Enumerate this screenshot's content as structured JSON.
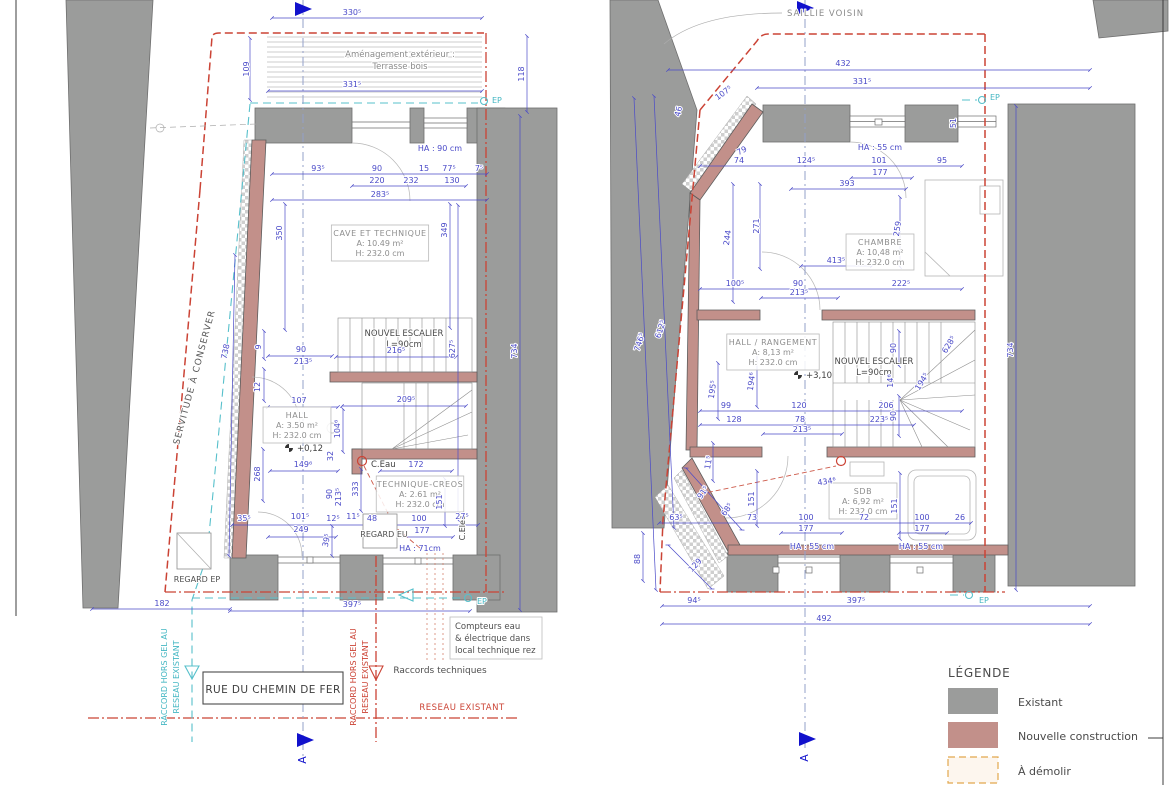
{
  "colors": {
    "existing": "#9b9c9b",
    "new_construction": "#c2908a",
    "demolish_fill": "#fdf6ee",
    "demolish_border": "#e2a84e",
    "dimension": "#4a4ac8",
    "boundary_red": "#cb4335",
    "utility_cyan": "#45b7c3",
    "section_blue": "#1111cc",
    "text_gray": "#8e8e8e",
    "text_dark": "#4a4a4a"
  },
  "legend": {
    "title": "LÉGENDE",
    "items": [
      {
        "label": "Existant"
      },
      {
        "label": "Nouvelle construction"
      },
      {
        "label": "À démolir"
      }
    ]
  },
  "street": {
    "label": "RUE DU CHEMIN DE FER"
  },
  "annotations": {
    "saillie_voisin": "SAILLIE VOISIN",
    "amenagement_line1": "Aménagement extérieur :",
    "amenagement_line2": "Terrasse bois",
    "servitude": "SERVITUDE À CONSERVER",
    "raccord_gel_line1": "RACCORD HORS GEL AU",
    "raccord_gel_line2": "RESEAU EXISTANT",
    "raccords_techniques": "Raccords techniques",
    "reseau_existant": "RESEAU EXISTANT",
    "compteurs_lines": [
      "Compteurs eau",
      "& électrique  dans",
      "local technique rez"
    ],
    "regard_ep": "REGARD EP",
    "regard_eu": "REGARD EU",
    "c_eau": "C.Eau",
    "c_elec": "C.Elec",
    "ep": "EP",
    "section_letter": "A",
    "ha_90": "HA : 90 cm",
    "ha_71": "HA : 71cm",
    "ha_55": "HA : 55 cm",
    "level_left": "+0,12",
    "level_right": "+3,10"
  },
  "rooms": [
    {
      "id": "cave",
      "cx": 380,
      "cy": 243,
      "lines": [
        "CAVE ET TECHNIQUE",
        "A: 10.49 m²",
        "H: 232.0 cm"
      ]
    },
    {
      "id": "hall-left",
      "cx": 297,
      "cy": 425,
      "lines": [
        "HALL",
        "A: 3.50 m²",
        "H: 232.0 cm"
      ]
    },
    {
      "id": "technique-creos",
      "cx": 420,
      "cy": 494,
      "lines": [
        "TECHNIQUE-CREOS",
        "A: 2.61 m²",
        "H: 232.0 cm"
      ]
    },
    {
      "id": "chambre",
      "cx": 880,
      "cy": 252,
      "lines": [
        "CHAMBRE",
        "A: 10,48 m²",
        "H: 232.0 cm"
      ]
    },
    {
      "id": "hall-rangement",
      "cx": 773,
      "cy": 352,
      "lines": [
        "HALL / RANGEMENT",
        "A: 8,13 m²",
        "H: 232.0 cm"
      ]
    },
    {
      "id": "sdb",
      "cx": 863,
      "cy": 501,
      "lines": [
        "SDB",
        "A: 6,92 m²",
        "H: 232.0 cm"
      ]
    }
  ],
  "stair_labels": [
    {
      "cx": 404,
      "cy": 336,
      "lines": [
        "NOUVEL ESCALIER",
        "L=90cm"
      ]
    },
    {
      "cx": 874,
      "cy": 364,
      "lines": [
        "NOUVEL ESCALIER",
        "L=90cm"
      ]
    }
  ],
  "dims_left": [
    {
      "x": 352,
      "y": 15,
      "t": "330⁵"
    },
    {
      "x": 249,
      "y": 69,
      "t": "109",
      "r": -90
    },
    {
      "x": 352,
      "y": 87,
      "t": "331⁵"
    },
    {
      "x": 524,
      "y": 74,
      "t": "118",
      "r": -90
    },
    {
      "x": 318,
      "y": 171,
      "t": "93⁵"
    },
    {
      "x": 377,
      "y": 171,
      "t": "90"
    },
    {
      "x": 424,
      "y": 171,
      "t": "15"
    },
    {
      "x": 449,
      "y": 171,
      "t": "77⁵"
    },
    {
      "x": 479,
      "y": 171,
      "t": "7⁵"
    },
    {
      "x": 377,
      "y": 183,
      "t": "220"
    },
    {
      "x": 411,
      "y": 183,
      "t": "232"
    },
    {
      "x": 452,
      "y": 183,
      "t": "130"
    },
    {
      "x": 380,
      "y": 197,
      "t": "283⁵"
    },
    {
      "x": 282,
      "y": 233,
      "t": "350",
      "r": -90
    },
    {
      "x": 447,
      "y": 230,
      "t": "349",
      "r": -90
    },
    {
      "x": 228,
      "y": 352,
      "t": "738",
      "r": -78
    },
    {
      "x": 261,
      "y": 347,
      "t": "9",
      "r": -90
    },
    {
      "x": 260,
      "y": 387,
      "t": "12",
      "r": -90
    },
    {
      "x": 301,
      "y": 352,
      "t": "90"
    },
    {
      "x": 303,
      "y": 364,
      "t": "213⁵"
    },
    {
      "x": 396,
      "y": 353,
      "t": "216⁵"
    },
    {
      "x": 455,
      "y": 349,
      "t": "627⁵",
      "r": -90
    },
    {
      "x": 517,
      "y": 351,
      "t": "734",
      "r": -90
    },
    {
      "x": 299,
      "y": 403,
      "t": "107"
    },
    {
      "x": 406,
      "y": 402,
      "t": "209⁵"
    },
    {
      "x": 340,
      "y": 429,
      "t": "104⁶",
      "r": -90
    },
    {
      "x": 260,
      "y": 474,
      "t": "268",
      "r": -90
    },
    {
      "x": 303,
      "y": 467,
      "t": "149⁶"
    },
    {
      "x": 333,
      "y": 456,
      "t": "32",
      "r": -90
    },
    {
      "x": 416,
      "y": 467,
      "t": "172"
    },
    {
      "x": 358,
      "y": 489,
      "t": "333",
      "r": -90
    },
    {
      "x": 332,
      "y": 494,
      "t": "90",
      "r": -90
    },
    {
      "x": 341,
      "y": 497,
      "t": "213⁵",
      "r": -90
    },
    {
      "x": 442,
      "y": 502,
      "t": "151",
      "r": -90
    },
    {
      "x": 244,
      "y": 521,
      "t": "35⁵"
    },
    {
      "x": 300,
      "y": 519,
      "t": "101⁵"
    },
    {
      "x": 301,
      "y": 532,
      "t": "249"
    },
    {
      "x": 333,
      "y": 521,
      "t": "12⁵"
    },
    {
      "x": 353,
      "y": 519,
      "t": "11⁵"
    },
    {
      "x": 372,
      "y": 521,
      "t": "48"
    },
    {
      "x": 419,
      "y": 521,
      "t": "100"
    },
    {
      "x": 422,
      "y": 533,
      "t": "177"
    },
    {
      "x": 462,
      "y": 519,
      "t": "27⁵"
    },
    {
      "x": 329,
      "y": 541,
      "t": "39⁵",
      "r": -78
    },
    {
      "x": 162,
      "y": 606,
      "t": "182"
    },
    {
      "x": 352,
      "y": 607,
      "t": "397⁵"
    }
  ],
  "dims_right": [
    {
      "x": 843,
      "y": 66,
      "t": "432"
    },
    {
      "x": 862,
      "y": 84,
      "t": "331⁵"
    },
    {
      "x": 725,
      "y": 95,
      "t": "107⁵",
      "r": -36
    },
    {
      "x": 681,
      "y": 112,
      "t": "46",
      "r": -76
    },
    {
      "x": 956,
      "y": 123,
      "t": "51",
      "r": -90
    },
    {
      "x": 743,
      "y": 153,
      "t": "79",
      "r": -28
    },
    {
      "x": 739,
      "y": 163,
      "t": "74"
    },
    {
      "x": 806,
      "y": 163,
      "t": "124⁵"
    },
    {
      "x": 879,
      "y": 163,
      "t": "101"
    },
    {
      "x": 880,
      "y": 175,
      "t": "177"
    },
    {
      "x": 942,
      "y": 163,
      "t": "95"
    },
    {
      "x": 847,
      "y": 186,
      "t": "393"
    },
    {
      "x": 730,
      "y": 238,
      "t": "244",
      "r": -82
    },
    {
      "x": 759,
      "y": 226,
      "t": "271",
      "r": -90
    },
    {
      "x": 900,
      "y": 229,
      "t": "259",
      "r": -82
    },
    {
      "x": 836,
      "y": 263,
      "t": "413⁵"
    },
    {
      "x": 735,
      "y": 286,
      "t": "100⁵"
    },
    {
      "x": 798,
      "y": 286,
      "t": "90"
    },
    {
      "x": 799,
      "y": 295,
      "t": "213⁵"
    },
    {
      "x": 901,
      "y": 286,
      "t": "222⁵"
    },
    {
      "x": 642,
      "y": 343,
      "t": "746⁵",
      "r": -72
    },
    {
      "x": 663,
      "y": 330,
      "t": "612⁵",
      "r": -72
    },
    {
      "x": 1013,
      "y": 350,
      "t": "734",
      "r": -90
    },
    {
      "x": 715,
      "y": 390,
      "t": "195⁵",
      "r": -82
    },
    {
      "x": 754,
      "y": 382,
      "t": "194⁶",
      "r": -82
    },
    {
      "x": 896,
      "y": 348,
      "t": "90",
      "r": -90
    },
    {
      "x": 893,
      "y": 381,
      "t": "14⁶",
      "r": -90
    },
    {
      "x": 924,
      "y": 383,
      "t": "194⁵",
      "r": -58
    },
    {
      "x": 951,
      "y": 346,
      "t": "628⁵",
      "r": -58
    },
    {
      "x": 896,
      "y": 416,
      "t": "90",
      "r": -90
    },
    {
      "x": 726,
      "y": 408,
      "t": "99"
    },
    {
      "x": 799,
      "y": 408,
      "t": "120"
    },
    {
      "x": 886,
      "y": 408,
      "t": "206"
    },
    {
      "x": 734,
      "y": 422,
      "t": "128"
    },
    {
      "x": 800,
      "y": 422,
      "t": "78"
    },
    {
      "x": 802,
      "y": 432,
      "t": "213⁵"
    },
    {
      "x": 879,
      "y": 422,
      "t": "223⁵"
    },
    {
      "x": 640,
      "y": 559,
      "t": "88",
      "r": -90
    },
    {
      "x": 711,
      "y": 463,
      "t": "11⁵",
      "r": -80
    },
    {
      "x": 705,
      "y": 494,
      "t": "91⁵",
      "r": -55
    },
    {
      "x": 729,
      "y": 511,
      "t": "68⁵",
      "r": -55
    },
    {
      "x": 676,
      "y": 520,
      "t": "63⁵"
    },
    {
      "x": 752,
      "y": 520,
      "t": "73"
    },
    {
      "x": 806,
      "y": 520,
      "t": "100"
    },
    {
      "x": 806,
      "y": 531,
      "t": "177"
    },
    {
      "x": 864,
      "y": 520,
      "t": "72"
    },
    {
      "x": 922,
      "y": 520,
      "t": "100"
    },
    {
      "x": 922,
      "y": 531,
      "t": "177"
    },
    {
      "x": 960,
      "y": 520,
      "t": "26"
    },
    {
      "x": 754,
      "y": 499,
      "t": "151",
      "r": -90
    },
    {
      "x": 897,
      "y": 506,
      "t": "151",
      "r": -90
    },
    {
      "x": 827,
      "y": 484,
      "t": "434⁶",
      "r": -8
    },
    {
      "x": 697,
      "y": 567,
      "t": "129",
      "r": -46
    },
    {
      "x": 694,
      "y": 603,
      "t": "94⁵"
    },
    {
      "x": 856,
      "y": 603,
      "t": "397⁵"
    },
    {
      "x": 824,
      "y": 621,
      "t": "492"
    }
  ]
}
